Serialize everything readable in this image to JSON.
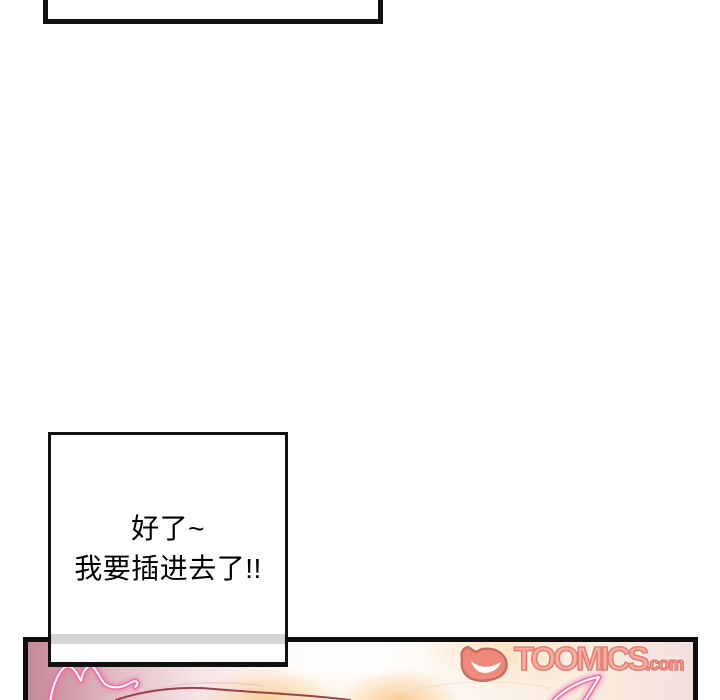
{
  "speech_bubbles": {
    "top_cropped": {
      "text": ""
    },
    "main": {
      "lines": [
        "好了~",
        "我要插进去了!!"
      ]
    }
  },
  "watermark": {
    "brand": "TOOMICS",
    "suffix": ".com"
  },
  "colors": {
    "ink": "#111111",
    "paper": "#ffffff",
    "bubble_fill": "#ffffff",
    "overlap_strip": "#d4d4d4",
    "panel_rose": "#c48b98",
    "panel_pink_light": "#f3dede",
    "panel_cream": "#f8e9dc",
    "glow_orange": "#f9c480",
    "neon_pink": "#f26ba0",
    "neon_core": "#ffffff",
    "line_deep_red": "#8e2436",
    "logo_fill": "#f7a89c",
    "logo_outline": "#e3766b"
  }
}
